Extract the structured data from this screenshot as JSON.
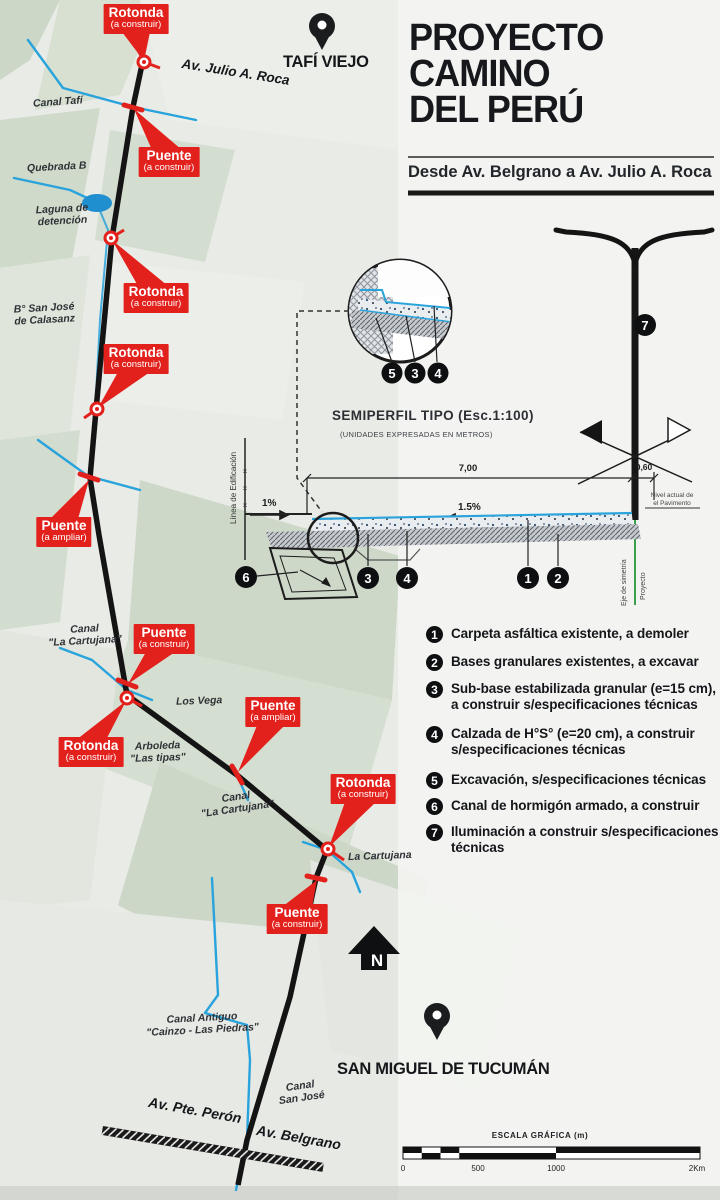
{
  "title": {
    "line1": "PROYECTO",
    "line2": "CAMINO",
    "line3": "DEL PERÚ",
    "subtitle": "Desde Av. Belgrano a Av. Julio A. Roca"
  },
  "map": {
    "city_top": "TAFÍ VIEJO",
    "city_bottom": "SAN MIGUEL DE TUCUMÁN",
    "north": "N",
    "roads": {
      "julio_roca": "Av. Julio A. Roca",
      "pte_peron": "Av. Pte. Perón",
      "belgrano": "Av. Belgrano"
    },
    "labels": {
      "canal_tafi": "Canal Tafí",
      "quebrada": "Quebrada B",
      "laguna_1": "Laguna de",
      "laguna_2": "detención",
      "barrio_1": "B° San José",
      "barrio_2": "de Calasanz",
      "cartujana_a1": "Canal",
      "cartujana_a2": "\"La Cartujana\"",
      "los_vega": "Los Vega",
      "arboleda_1": "Arboleda",
      "arboleda_2": "\"Las tipas\"",
      "cartujana_b1": "Canal",
      "cartujana_b2": "\"La Cartujana\"",
      "la_cartujana": "La Cartujana",
      "canal_antiguo_1": "Canal Antiguo",
      "canal_antiguo_2": "\"Cainzo - Las Piedras\"",
      "canal_sanjose_1": "Canal",
      "canal_sanjose_2": "San José"
    },
    "callouts": {
      "rotonda": "Rotonda",
      "puente": "Puente",
      "a_construir": "(a construir)",
      "a_ampliar": "(a ampliar)"
    }
  },
  "section": {
    "title": "SEMIPERFIL TIPO",
    "scale": "(Esc.1:100)",
    "units": "(UNIDADES EXPRESADAS EN METROS)",
    "dim_width": "7,00",
    "dim_right": "0,60",
    "slope_left": "1%",
    "slope_center": "1.5%",
    "linea_edificacion": "Línea de Edificación",
    "eje_1": "Eje de simetría",
    "eje_2": "Proyecto",
    "nivel_1": "Nivel actual de",
    "nivel_2": "el Pavimento"
  },
  "legend": {
    "items": [
      {
        "num": "1",
        "text": "Carpeta asfáltica existente, a demoler"
      },
      {
        "num": "2",
        "text": "Bases granulares existentes, a excavar"
      },
      {
        "num": "3",
        "text": "Sub-base estabilizada granular (e=15 cm), a construir s/especificaciones técnicas"
      },
      {
        "num": "4",
        "text": "Calzada de H°S° (e=20 cm), a construir s/especificaciones técnicas"
      },
      {
        "num": "5",
        "text": "Excavación, s/especificaciones técnicas"
      },
      {
        "num": "6",
        "text": "Canal de hormigón armado, a construir"
      },
      {
        "num": "7",
        "text": "Iluminación a construir s/especificaciones técnicas"
      }
    ]
  },
  "scalebar": {
    "title": "ESCALA GRÁFICA (m)",
    "t0": "0",
    "t500": "500",
    "t1000": "1000",
    "t2000": "2Km"
  },
  "colors": {
    "red": "#e3211c",
    "canal_blue": "#29a3dc",
    "axis_green": "#3aa14a",
    "ink": "#161616"
  }
}
